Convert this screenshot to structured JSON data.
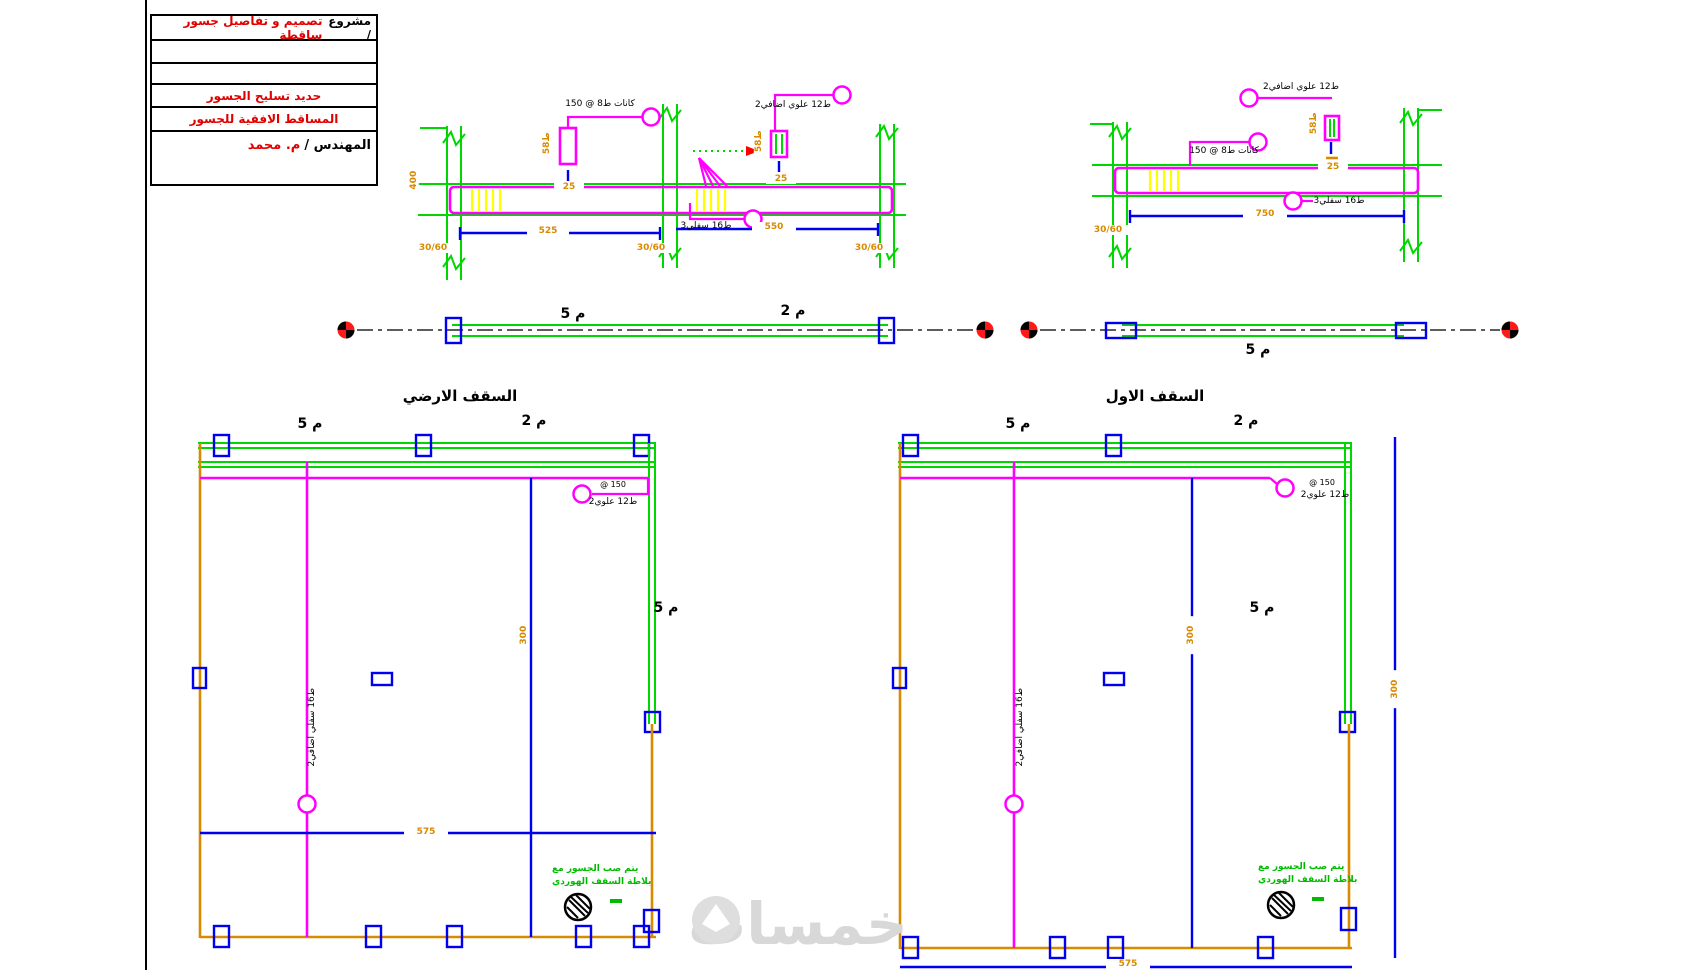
{
  "palette": {
    "beam_outline": "#ff00ff",
    "columns_slabs": "#00d600",
    "ties_dim_lines": "#0000ee",
    "dimension_text": "#d88a00",
    "stirrups": "#ffff00",
    "grid_bubble": "#ff1a1a",
    "notes_green": "#00bb00",
    "annotation_red": "#e00000",
    "watermark_gray": "#d8d8d8"
  },
  "title_block": {
    "row1_label": "مشروع /",
    "row1_value": "تصميم و تفاصيل جسور ساقطة",
    "row2": "",
    "row3": "",
    "row4": "حديد تسليح الجسور",
    "row5": "المساقط الافقية للجسور",
    "row6_label": "المهندس /",
    "row6_value": "م. محمد"
  },
  "titles": {
    "left_plan": "السقف الارضي",
    "right_plan": "السقف الاول"
  },
  "labels": {
    "m5": "م 5",
    "m2": "م 2"
  },
  "dims": {
    "d400": "400",
    "d525": "525",
    "d550": "550",
    "d750": "750",
    "d300": "300",
    "d575": "575",
    "s5t8": "5ط8",
    "s25": "25",
    "c3060": "30/60"
  },
  "callouts": {
    "stirrups": "كانات ط8 @ 150",
    "top_add": "2ط12 علوي اضافي",
    "bottom_main": "3ط16 سفلي",
    "plan_top": "2ط12 علوي",
    "plan_top_sub": "@ 150",
    "plan_mid": "2ط16 سفلي اضافي"
  },
  "notes": {
    "line1": "يتم صب الجسور مع",
    "line2": "بلاطة السقف الهوردي"
  },
  "watermark": {
    "text": "خمسات"
  }
}
